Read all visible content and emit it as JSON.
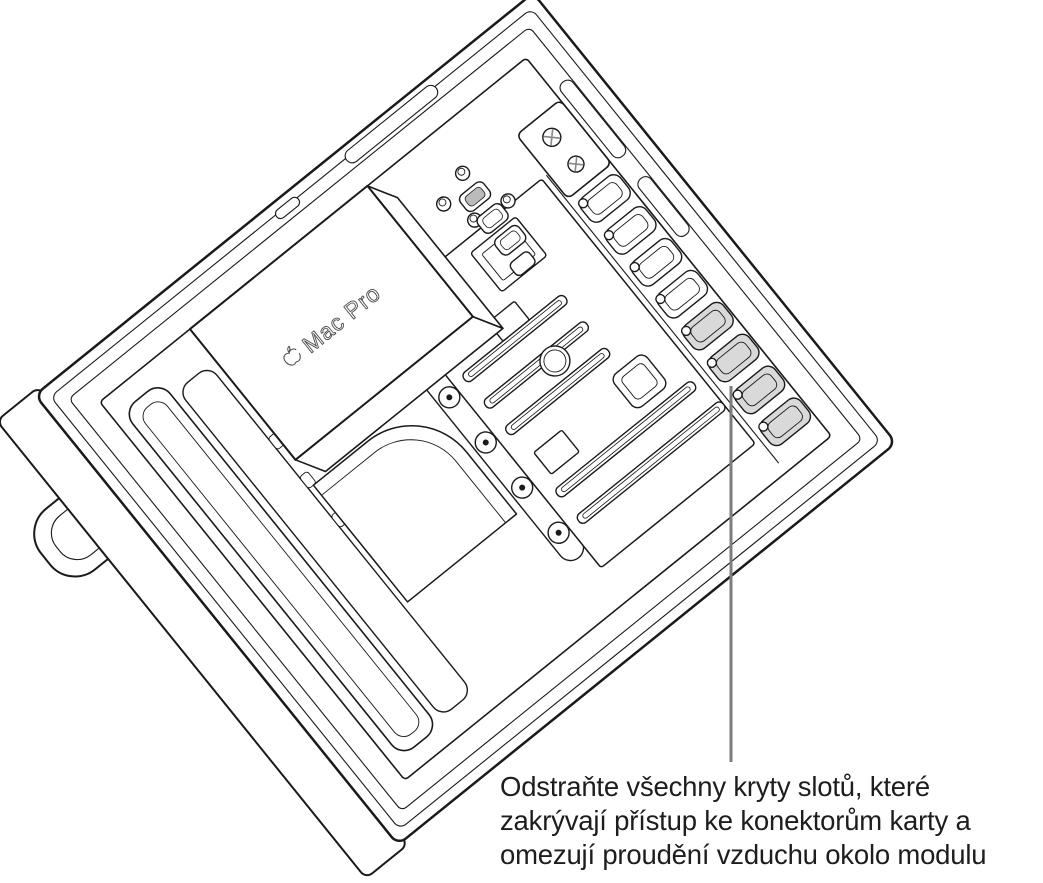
{
  "figure": {
    "type": "technical-line-illustration",
    "subject": "Mac Pro (rack) with cover removed showing interior; PCIe slot covers highlighted by a callout",
    "device_label": {
      "icon": "apple-logo",
      "text": "Mac Pro"
    },
    "slot_covers": {
      "total": 8,
      "highlighted": 4
    },
    "callout": {
      "lines": [
        "Odstraňte všechny kryty slotů, které",
        "zakrývají přístup ke konektorům karty a",
        "omezují proudění vzduchu okolo modulu"
      ]
    },
    "colors": {
      "background": "#ffffff",
      "line": "#1a1a1a",
      "highlight_fill": "#d9d9d9",
      "callout_line": "#7d7d7d",
      "text": "#1d1d1f"
    }
  }
}
